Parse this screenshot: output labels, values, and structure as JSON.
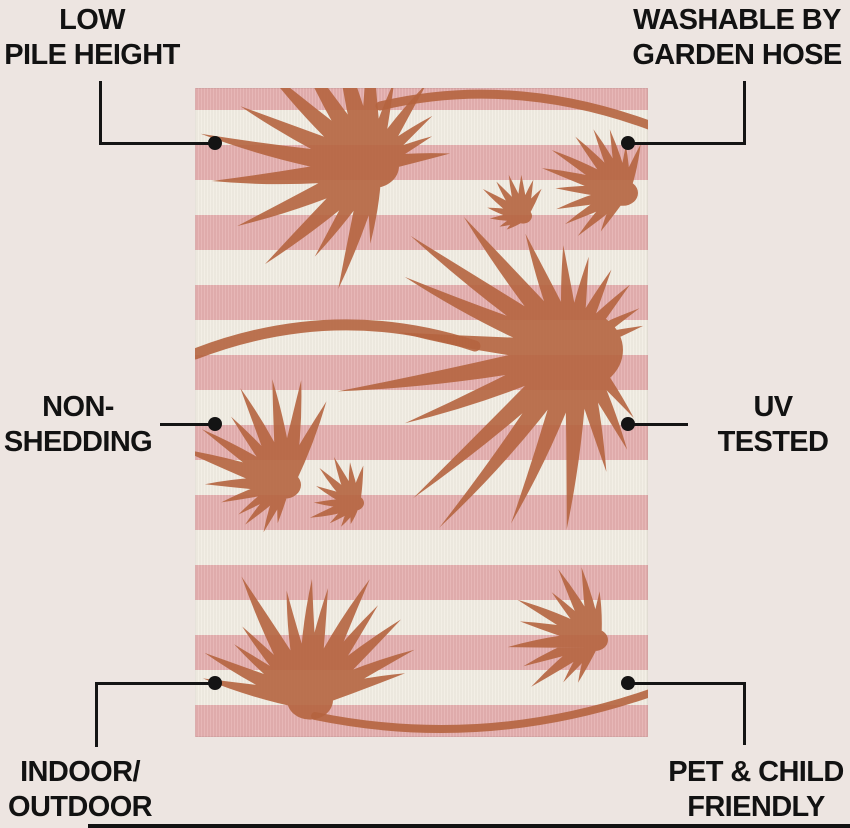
{
  "page": {
    "bg": "#EDE5E1",
    "text_color": "#121212",
    "callout_color": "#141414",
    "bottom_bar_color": "#121212"
  },
  "labels": {
    "low_pile": {
      "line1": "LOW",
      "line2": "PILE HEIGHT"
    },
    "washable": {
      "line1": "WASHABLE BY",
      "line2": "GARDEN HOSE"
    },
    "non_shedding": {
      "line1": "NON-",
      "line2": "SHEDDING"
    },
    "uv_tested": {
      "line1": "UV",
      "line2": "TESTED"
    },
    "indoor_outdoor": {
      "line1": "INDOOR/",
      "line2": "OUTDOOR"
    },
    "pet_child": {
      "line1": "PET & CHILD",
      "line2": "FRIENDLY"
    }
  },
  "callouts": {
    "lines": [
      {
        "x": 99,
        "y": 81,
        "w": 2.5,
        "h": 64
      },
      {
        "x": 99,
        "y": 142,
        "w": 117,
        "h": 2.5
      },
      {
        "x": 743,
        "y": 81,
        "w": 2.5,
        "h": 64
      },
      {
        "x": 628,
        "y": 142,
        "w": 117,
        "h": 2.5
      },
      {
        "x": 160,
        "y": 423,
        "w": 56,
        "h": 2.5
      },
      {
        "x": 628,
        "y": 423,
        "w": 60,
        "h": 2.5
      },
      {
        "x": 95,
        "y": 682,
        "w": 2.5,
        "h": 65
      },
      {
        "x": 95,
        "y": 682,
        "w": 121,
        "h": 2.5
      },
      {
        "x": 628,
        "y": 682,
        "w": 117,
        "h": 2.5
      },
      {
        "x": 743,
        "y": 682,
        "w": 2.5,
        "h": 63
      }
    ],
    "dots": [
      {
        "x": 215,
        "y": 143
      },
      {
        "x": 628,
        "y": 143
      },
      {
        "x": 215,
        "y": 424
      },
      {
        "x": 628,
        "y": 424
      },
      {
        "x": 215,
        "y": 683
      },
      {
        "x": 628,
        "y": 683
      }
    ]
  },
  "rug": {
    "x": 195,
    "y": 88,
    "width": 453,
    "height": 649,
    "stripe_pink": "#E4AFAF",
    "stripe_cream": "#F2EDE3",
    "leaf": "#B5643F",
    "stems": [
      {
        "d": "M 185 18 Q 320 -14 462 40",
        "w": 9
      },
      {
        "d": "M 0 266 Q 140 212 280 258",
        "w": 11
      },
      {
        "d": "M 120 628 Q 290 663 458 604",
        "w": 8
      }
    ],
    "palms": [
      {
        "cx": 178,
        "cy": 78,
        "a0": 85,
        "a1": 345,
        "n": 17,
        "rMax": 175,
        "longDir": 185,
        "coreR": 26,
        "bend": 0.1
      },
      {
        "cx": 428,
        "cy": 105,
        "a0": 125,
        "a1": 295,
        "n": 12,
        "rMax": 80,
        "longDir": 210,
        "coreR": 15,
        "bend": -0.08
      },
      {
        "cx": 328,
        "cy": 128,
        "a0": 135,
        "a1": 300,
        "n": 10,
        "rMax": 45,
        "longDir": 230,
        "coreR": 9,
        "bend": 0.08
      },
      {
        "cx": 380,
        "cy": 262,
        "a0": 40,
        "a1": 335,
        "n": 20,
        "rMax": 225,
        "longDir": 160,
        "coreR": 48,
        "bend": 0.12
      },
      {
        "cx": 90,
        "cy": 397,
        "a0": 105,
        "a1": 300,
        "n": 13,
        "rMax": 112,
        "longDir": 245,
        "coreR": 16,
        "bend": -0.08
      },
      {
        "cx": 160,
        "cy": 415,
        "a0": 95,
        "a1": 280,
        "n": 10,
        "rMax": 50,
        "longDir": 200,
        "coreR": 9,
        "bend": 0.08
      },
      {
        "cx": 115,
        "cy": 612,
        "a0": 185,
        "a1": 340,
        "n": 13,
        "rMax": 138,
        "longDir": 262,
        "coreR": 23,
        "bend": 0.1
      },
      {
        "cx": 400,
        "cy": 552,
        "a0": 115,
        "a1": 280,
        "n": 11,
        "rMax": 85,
        "longDir": 200,
        "coreR": 13,
        "bend": -0.08
      }
    ]
  }
}
